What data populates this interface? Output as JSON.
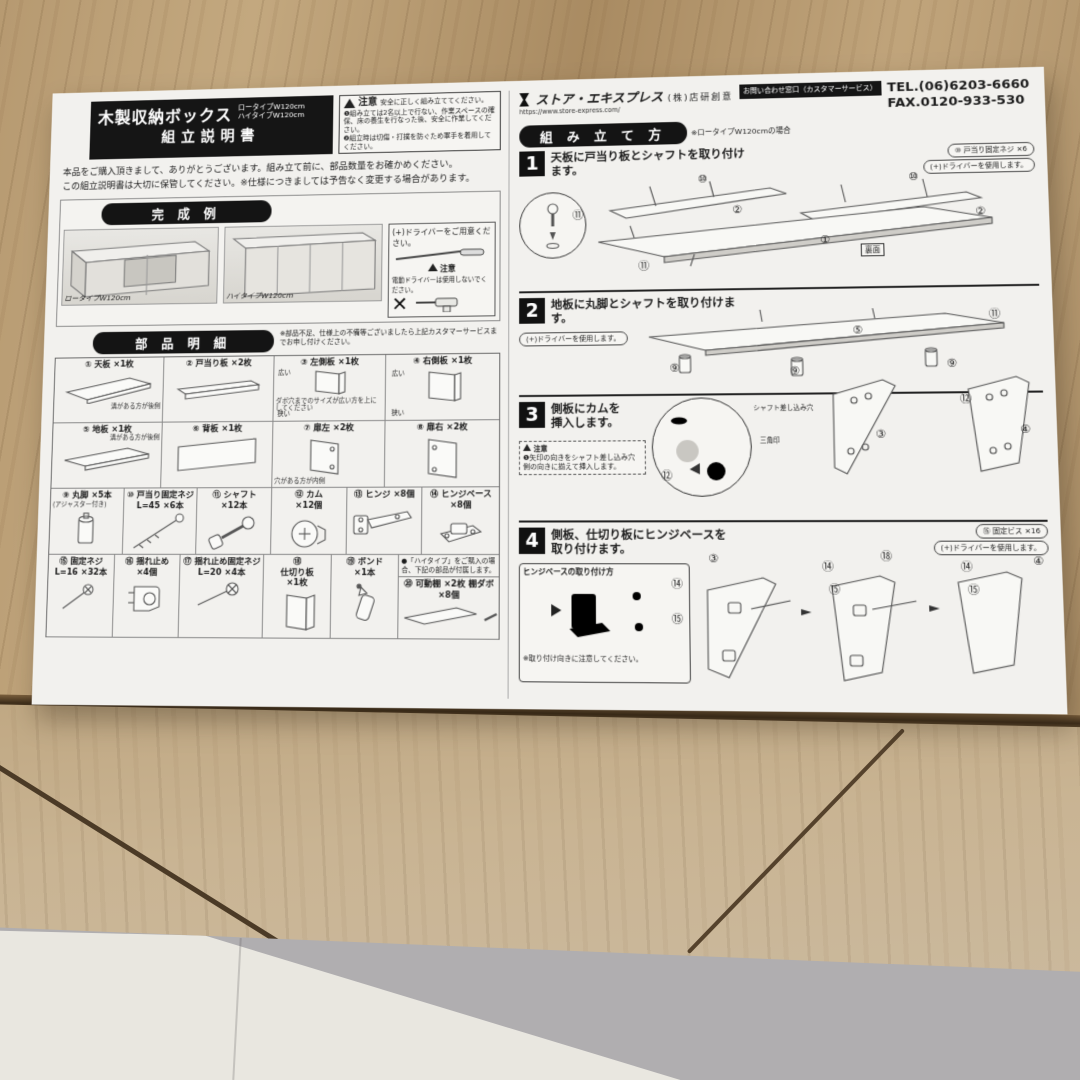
{
  "colors": {
    "paper": "#f2f1ee",
    "ink": "#1c1c1c",
    "badge_black": "#141414",
    "wood_top": "#b5986f",
    "wood_front": "#c6b091",
    "floor_light": "#e9e7e0",
    "floor_shadow": "#b0aeb0"
  },
  "sheet": {
    "header": {
      "product_title": "木製収納ボックス",
      "type1": "ロータイプW120cm",
      "type2": "ハイタイプW120cm",
      "doc_title": "組立説明書",
      "caution_title": "注意",
      "caution_lead": "安全に正しく組み立ててください。",
      "caution_item1": "❶組み立ては2名以上で行ない、作業スペースの確保、床の養生を行なった後、安全に作業してください。",
      "caution_item2": "❷組立時は切傷・打撲を防ぐため軍手を着用してください。"
    },
    "company": {
      "logo": "ストア・エキスプレス",
      "name": "(株)店研創意",
      "url": "https://www.store-express.com/",
      "contact_badge": "お問い合わせ窓口（カスタマーサービス）",
      "tel": "TEL.(06)6203-6660",
      "fax": "FAX.0120-933-530"
    },
    "intro1": "本品をご購入頂きまして、ありがとうございます。組み立て前に、部品数量をお確かめください。",
    "intro2": "この組立説明書は大切に保管してください。※仕様につきましては予告なく変更する場合があります。",
    "finished": {
      "header": "完 成 例",
      "cap1": "ロータイプW120cm",
      "cap2": "ハイタイプW120cm",
      "tool_note": "(+)ドライバーをご用意ください。",
      "tool_caution_title": "注意",
      "tool_caution": "電動ドライバーは使用しないでください。",
      "xmark": "✕"
    },
    "parts": {
      "header": "部 品 明 細",
      "note": "※部品不足、仕様上の不備等ございましたら上記カスタマーサービスまでお申し付けください。",
      "hitype_note": "●「ハイタイプ」をご購入の場合、下記の部品が付属します。",
      "items": [
        {
          "num": "①",
          "name": "天板",
          "qty": "×1枚",
          "note": "溝がある方が後側"
        },
        {
          "num": "②",
          "name": "戸当り板",
          "qty": "×2枚",
          "note": ""
        },
        {
          "num": "③",
          "name": "左側板",
          "qty": "×1枚",
          "note": "溝がある方が後側",
          "note2": "ダボ穴までのサイズが広い方を上にしてください",
          "tag_top": "広い",
          "tag_bottom": "狭い"
        },
        {
          "num": "④",
          "name": "右側板",
          "qty": "×1枚",
          "note": "",
          "tag_top": "広い",
          "tag_bottom": "狭い"
        },
        {
          "num": "⑤",
          "name": "地板",
          "qty": "×1枚",
          "note": "溝がある方が後側"
        },
        {
          "num": "⑥",
          "name": "背板",
          "qty": "×1枚",
          "note": ""
        },
        {
          "num": "⑦",
          "name": "扉左",
          "qty": "×2枚",
          "note": "穴がある方が内側"
        },
        {
          "num": "⑧",
          "name": "扉右",
          "qty": "×2枚",
          "note": ""
        },
        {
          "num": "⑨",
          "name": "丸脚",
          "qty": "×5本",
          "note": "(アジャスター付き)"
        },
        {
          "num": "⑩",
          "name": "戸当り固定ネジ",
          "size": "L=45",
          "qty": "×6本",
          "note": ""
        },
        {
          "num": "⑪",
          "name": "シャフト",
          "qty": "×12本",
          "note": ""
        },
        {
          "num": "⑫",
          "name": "カム",
          "qty": "×12個",
          "note": ""
        },
        {
          "num": "⑬",
          "name": "ヒンジ",
          "qty": "×8個",
          "note": ""
        },
        {
          "num": "⑭",
          "name": "ヒンジベース",
          "qty": "×8個",
          "note": ""
        },
        {
          "num": "⑮",
          "name": "固定ネジ",
          "size": "L=16",
          "qty": "×32本",
          "note": ""
        },
        {
          "num": "⑯",
          "name": "揺れ止め",
          "qty": "×4個",
          "note": ""
        },
        {
          "num": "⑰",
          "name": "揺れ止め固定ネジ",
          "size": "L=20",
          "qty": "×4本",
          "note": ""
        },
        {
          "num": "⑱",
          "name": "仕切り板",
          "qty": "×1枚",
          "note": ""
        },
        {
          "num": "⑲",
          "name": "ボンド",
          "qty": "×1本",
          "note": ""
        },
        {
          "num": "⑳",
          "name": "可動棚",
          "qty": "×2枚",
          "name2": "棚ダボ",
          "qty2": "×8個",
          "note": ""
        }
      ]
    },
    "assembly": {
      "header": "組 み 立 て 方",
      "header_note": "※ロータイプW120cmの場合",
      "steps": [
        {
          "no": "1",
          "title": "天板に戸当り板とシャフトを取り付けます。",
          "side_note1": "⑩ 戸当り固定ネジ ×6",
          "side_note2": "(+)ドライバーを使用します。",
          "c0": "⑪",
          "c1": "⑩",
          "c2": "②",
          "c3": "⑩",
          "c4": "②",
          "c5": "①",
          "c6": "⑪",
          "extra_label": "裏面"
        },
        {
          "no": "2",
          "title": "地板に丸脚とシャフトを取り付けます。",
          "side_note1": "(+)ドライバーを使用します。",
          "c0": "⑪",
          "c1": "⑤",
          "c2": "⑨",
          "c3": "⑨",
          "c4": "⑨"
        },
        {
          "no": "3",
          "title": "側板にカムを挿入します。",
          "caution_title": "注意",
          "caution": "❶矢印の向きをシャフト差し込み穴側の向きに揃えて挿入します。",
          "inset_lbl1": "シャフト差し込み穴",
          "inset_lbl2": "三角印",
          "inset_lbl3": "⑫",
          "c0": "⑫",
          "c1": "③",
          "c2": "④"
        },
        {
          "no": "4",
          "title": "側板、仕切り板にヒンジベースを取り付けます。",
          "side_note1": "⑮ 固定ビス ×16",
          "side_note2": "(+)ドライバーを使用します。",
          "inset_title": "ヒンジベースの取り付け方",
          "inset_lbl1": "⑭",
          "inset_lbl2": "⑮",
          "inset_note": "※取り付け向きに注意してください。",
          "c0": "③",
          "c1": "⑭",
          "c2": "⑮",
          "c3": "⑱",
          "c4": "⑭",
          "c5": "⑮",
          "c6": "④"
        }
      ]
    }
  }
}
